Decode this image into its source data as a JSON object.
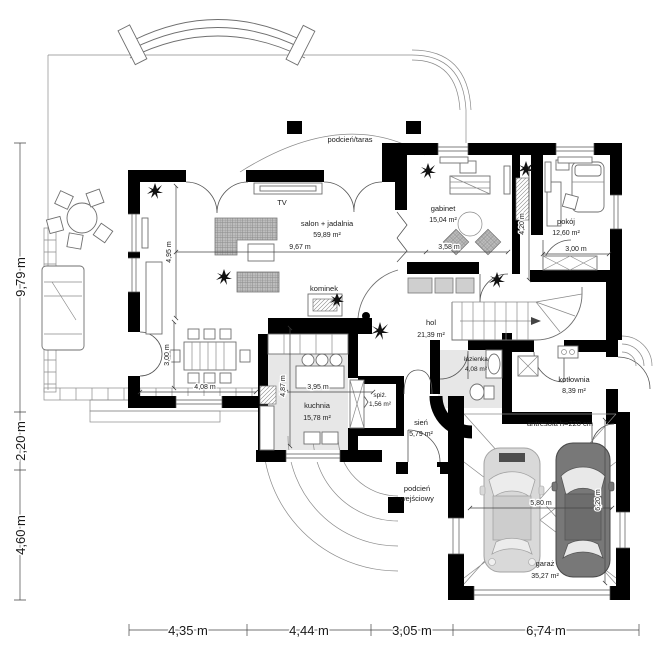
{
  "plan": {
    "type": "floor-plan",
    "floor": "parter",
    "rooms": [
      {
        "name": "podcień/taras",
        "area": ""
      },
      {
        "name": "salon + jadalnia",
        "area": "59,89 m²"
      },
      {
        "name": "gabinet",
        "area": "15,04 m²"
      },
      {
        "name": "pokój",
        "area": "12,60 m²"
      },
      {
        "name": "hol",
        "area": "21,39 m²"
      },
      {
        "name": "kuchnia",
        "area": "15,78 m²"
      },
      {
        "name": "spiż.",
        "area": "1,56 m²"
      },
      {
        "name": "sień",
        "area": "5,79 m²"
      },
      {
        "name": "łazienka",
        "area": "4,08 m²"
      },
      {
        "name": "kotłownia",
        "area": "8,39 m²"
      },
      {
        "name": "garaż",
        "area": "35,27 m²"
      },
      {
        "name": "kominek",
        "area": ""
      },
      {
        "name": "TV",
        "area": ""
      },
      {
        "name": "podcień",
        "name2": "wejściowy"
      },
      {
        "name": "antresola h=220 cm"
      }
    ],
    "dims_exterior": {
      "bottom": [
        "4,35 m",
        "4,44 m",
        "3,05 m",
        "6,74 m"
      ],
      "left": [
        "9,79 m",
        "2,20 m",
        "4,60 m"
      ]
    },
    "dims_interior": [
      "4,95 m",
      "9,67 m",
      "3,58 m",
      "4,20 m",
      "3,00 m",
      "3,00 m",
      "4,08 m",
      "3,95 m",
      "4,87 m",
      "5,80 m",
      "6,20 m"
    ],
    "colors": {
      "wall": "#000000",
      "floor_shade": "#e7e7e7",
      "car_light": "#d9d9d9",
      "car_dark": "#787878"
    }
  }
}
